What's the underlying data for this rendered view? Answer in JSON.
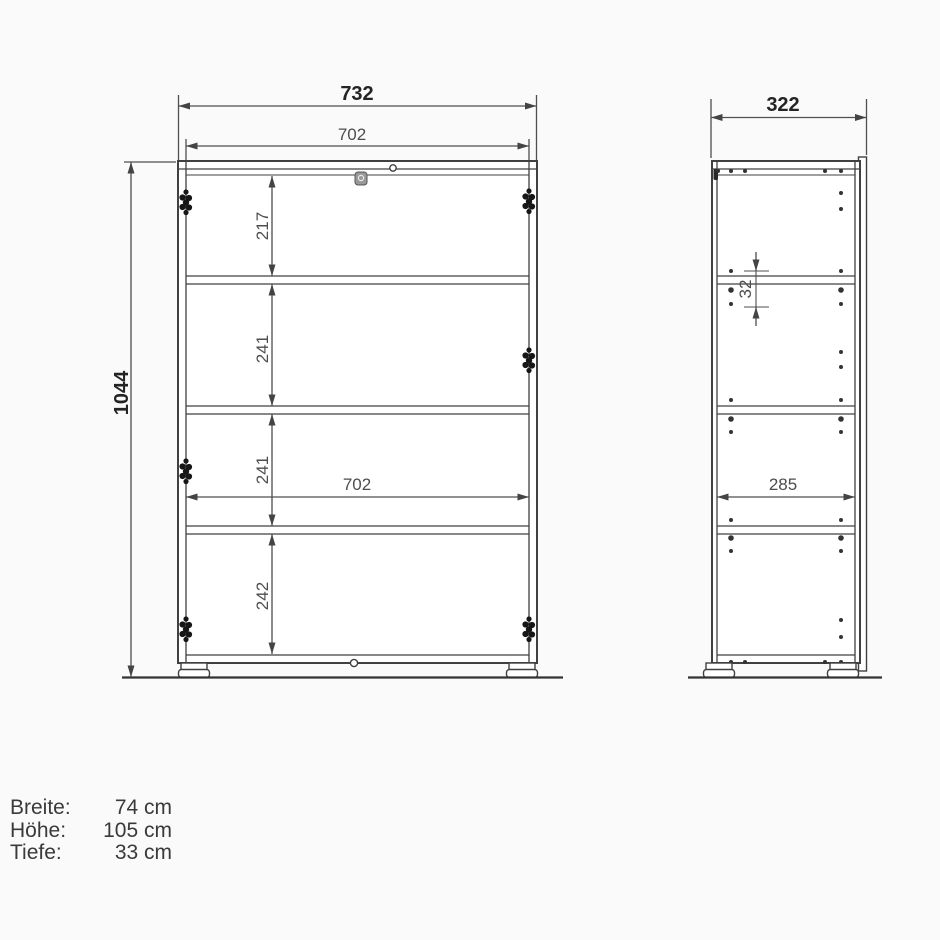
{
  "views": {
    "front": {
      "outer_width_mm": "732",
      "inner_width_top_mm": "702",
      "inner_width_mid_mm": "702",
      "outer_height_mm": "1044",
      "section_heights_mm": [
        "217",
        "241",
        "241",
        "242"
      ]
    },
    "side": {
      "outer_depth_mm": "322",
      "inner_depth_mm": "285",
      "hole_spacing_mm": "32"
    }
  },
  "footer": {
    "rows": [
      {
        "label": "Breite:",
        "value": "74 cm"
      },
      {
        "label": "Höhe:",
        "value": "105 cm"
      },
      {
        "label": "Tiefe:",
        "value": "33 cm"
      }
    ]
  },
  "colors": {
    "line": "#404040",
    "dim_line": "#4f4f4f",
    "text_bold": "#242424",
    "text_regular": "#4d4d4d",
    "background": "#fafafa"
  }
}
